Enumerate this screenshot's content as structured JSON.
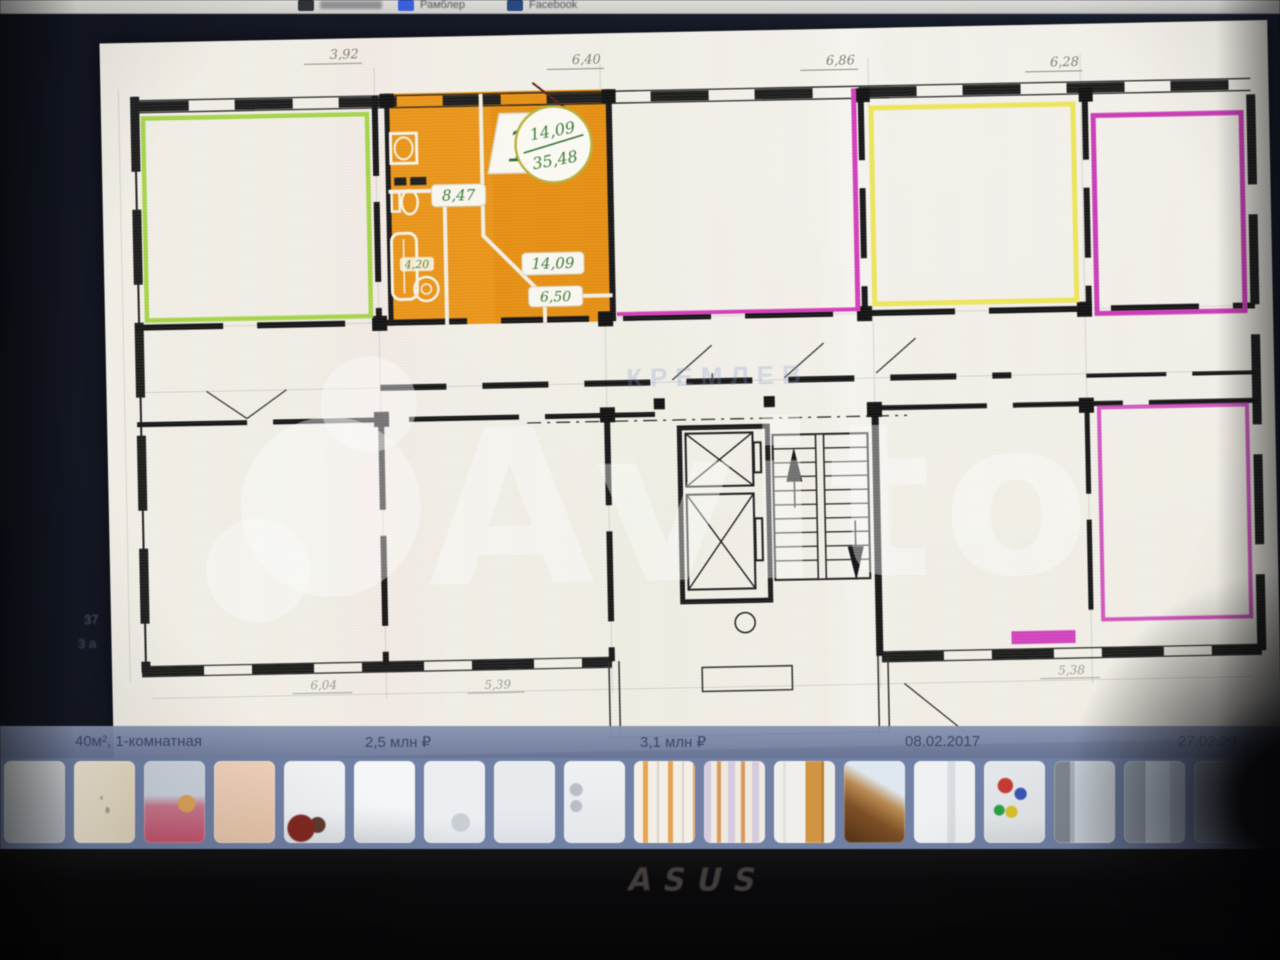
{
  "browser_bar": {
    "bookmarks": [
      {
        "label": "",
        "icon": "app-grid-icon"
      },
      {
        "label": "Рамблер",
        "icon": "rambler-icon"
      },
      {
        "label": "Facebook",
        "icon": "facebook-icon"
      }
    ]
  },
  "listing_bar": {
    "title": "40м², 1-комнатная",
    "price_primary": "2,5 млн ₽",
    "price_secondary": "3,1 млн ₽",
    "date_primary": "08.02.2017",
    "date_secondary": "27.02.20"
  },
  "floor_plan": {
    "unit_badge": {
      "number": "1",
      "area_living": "14,09",
      "area_total": "35,48"
    },
    "room_areas": {
      "hall": "8,47",
      "room": "14,09",
      "kitchen": "6,50",
      "bath": "4,20"
    },
    "dims_top": [
      "3,92",
      "6,40",
      "6,86",
      "6,28"
    ],
    "dims_bottom": [
      "6,04",
      "5,39",
      "5,38"
    ],
    "margin_notes": [
      "37",
      "3 а"
    ],
    "brand_watermark": "Avito",
    "corridor_watermark": "КРЕМЛЕВ",
    "colors": {
      "highlight_apartment": "#e8951c",
      "outline_green": "#a6d44c",
      "outline_yellow": "#efe65e",
      "outline_magenta": "#c83cb4",
      "label_green": "#3c7a3c",
      "paper": "#f2efe6"
    }
  },
  "gallery": {
    "thumbnails": [
      {
        "name": "floor-plan-gray",
        "bg": "linear-gradient(180deg,#d8dadc 0%,#c6cacf 50%,#babfc6 100%)"
      },
      {
        "name": "plan-sketch",
        "bg": "radial-gradient(ellipse at 55% 60%, rgba(100,90,70,.45) 0 4%, transparent 5%), radial-gradient(ellipse at 45% 45%, rgba(100,90,70,.35) 0 3%, transparent 4%), linear-gradient(100deg,#f0e9d8 0%,#e9dfc8 60%,#e2d6bc 100%)"
      },
      {
        "name": "bedroom-pink",
        "bg": "radial-gradient(circle at 70% 52%, #dba45c 0 14%, transparent 15%), linear-gradient(180deg,#ccd3dc 0 42%,#c87b90 55%,#c2556e 100%)"
      },
      {
        "name": "peach-wall",
        "bg": "linear-gradient(170deg,#eed3bc 0%,#e6c5ab 100%)"
      },
      {
        "name": "room-red-chair",
        "bg": "radial-gradient(circle at 28% 82%, #7e2a22 0 16%, transparent 18%), radial-gradient(circle at 55% 78%, #5e3a30 0 10%, transparent 12%), linear-gradient(180deg,#f0f1f3 0 60%,#dadee2 100%)"
      },
      {
        "name": "white-room",
        "bg": "linear-gradient(180deg,#f5f6f7 0 55%,#e9ebee 75%,#d3d7dc 100%)"
      },
      {
        "name": "kitchen-corner",
        "bg": "radial-gradient(circle at 60% 75%, #c9ced4 0 12%, transparent 14%), linear-gradient(180deg,#eceef1 0 70%,#dfe2e6 100%)"
      },
      {
        "name": "pale-room",
        "bg": "linear-gradient(180deg,#e8ebee 0 60%,#dce0e5 100%)"
      },
      {
        "name": "bathroom",
        "bg": "radial-gradient(circle at 20% 35%, #b9bec6 0 8%, transparent 10%), radial-gradient(circle at 20% 55%, #b9bec6 0 8%, transparent 10%), linear-gradient(180deg,#f0f1f3,#e4e7ea)"
      },
      {
        "name": "door-stripes",
        "bg": "repeating-linear-gradient(90deg,#f3efe7 0 9px,#e2a455 9px 14px,#f3efe7 14px 23px,#d8d2c8 23px 25px)"
      },
      {
        "name": "stripes-lilac",
        "bg": "repeating-linear-gradient(90deg,#d5cbde 0 7px,#efe9e0 7px 13px,#d99a5e 13px 17px,#efe9e0 17px 24px)"
      },
      {
        "name": "wood-door",
        "bg": "linear-gradient(90deg,#f0efec 0 15%,#e4e2de 15% 20%,#f0efec 20% 52%,#cf9446 52% 78%,#b97f35 78% 82%,#eceae6 82%)"
      },
      {
        "name": "balcony-wood",
        "bg": "linear-gradient(210deg,#dfe8f0 0 30%,#b98a54 45%,#7c4f26 65%,#4e3015 100%)"
      },
      {
        "name": "white-hallway",
        "bg": "linear-gradient(90deg,#f0f1f3 0 55%,#d9dde1 55% 68%,#eef0f2 68%)"
      },
      {
        "name": "playground",
        "bg": "radial-gradient(circle at 35% 30%, #c43b35 0 10%, transparent 12%), radial-gradient(circle at 60% 40%, #3a57b0 0 9%, transparent 11%), radial-gradient(circle at 45% 62%, #d8c22e 0 9%, transparent 11%), radial-gradient(circle at 25% 60%, #2f9e48 0 7%, transparent 9%), linear-gradient(180deg,#e3e7ea 0 70%,#d6dadd 100%)"
      },
      {
        "name": "winter-street",
        "bg": "linear-gradient(90deg,#7e858f 0 26%,#a8b0ba 26% 34%,#ccd3db 34%)"
      },
      {
        "name": "street-building",
        "bg": "linear-gradient(90deg,#9aa5b4 0 35%,#c3cedc 35% 75%,#aeb9c8 75%)"
      },
      {
        "name": "edge-dark",
        "bg": "linear-gradient(90deg,#8c96a8 0 40%,#5f6878 100%)"
      }
    ]
  },
  "device": {
    "brand_logo": "ASUS"
  }
}
